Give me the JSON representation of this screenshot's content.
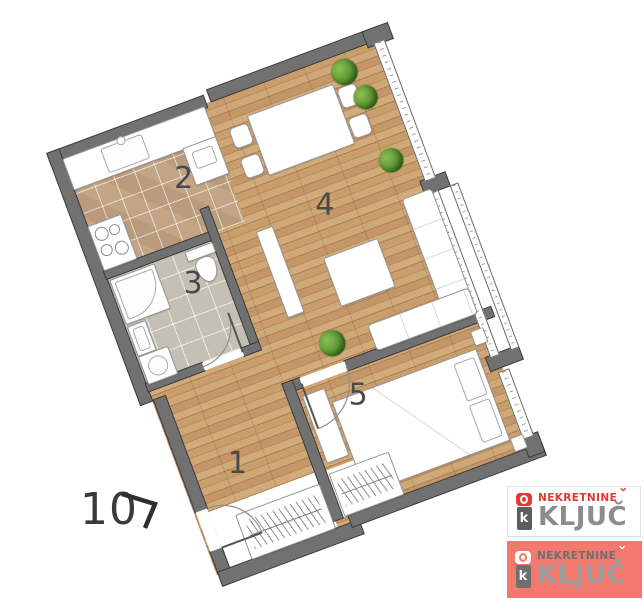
{
  "floorplan": {
    "unit_number": "10",
    "entrance_arrow": "chevron-right-arrow",
    "rooms": [
      {
        "label": "1",
        "name": "hallway"
      },
      {
        "label": "2",
        "name": "kitchen"
      },
      {
        "label": "3",
        "name": "bathroom"
      },
      {
        "label": "4",
        "name": "living-dining-room"
      },
      {
        "label": "5",
        "name": "bedroom"
      }
    ],
    "colors": {
      "wall": "#717171",
      "wall_outline": "#3b3b3b",
      "wood_floor": "#c49668",
      "kitchen_tile": "#c3a585",
      "bathroom_tile": "#c6c0b4",
      "plant": "#57922f"
    }
  },
  "logos": [
    {
      "line1": "NEKRETNINE",
      "line2": "KLJUČ",
      "caron": "ˇ",
      "icon": "key-icon",
      "icon_letter": "k",
      "background": "#ffffff",
      "accent": "#e23a31",
      "text_color": "#8c8c8c"
    },
    {
      "line1": "NEKRETNINE",
      "line2": "KLJUČ",
      "caron": "ˇ",
      "icon": "key-icon",
      "icon_letter": "k",
      "background": "#f3796f",
      "accent": "#ffffff",
      "text_color": "#9c9c9c"
    }
  ]
}
